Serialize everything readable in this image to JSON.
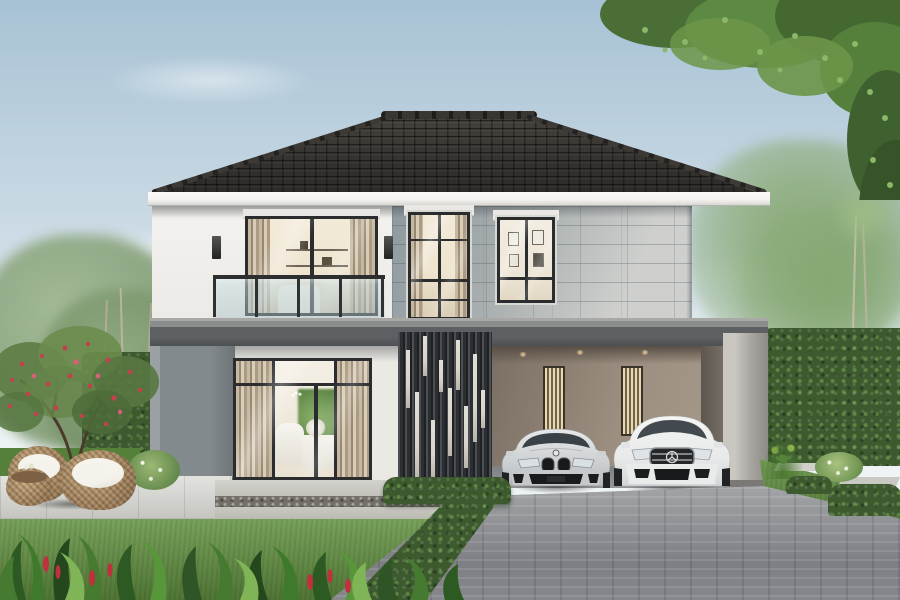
{
  "scene": {
    "type": "photorealistic architectural rendering",
    "setting": "two-story modern detached house, front elevation, daytime, landscaped garden",
    "objects": [
      "dark tiled hip roof with ridge caps",
      "white stucco second-floor wall",
      "gray stone tile cladding",
      "balcony with glass railing and sliding door",
      "sheer curtains behind glass",
      "tall gridded window",
      "square picture window showing framed art",
      "dark vertical slat privacy screen with light accent battens",
      "double carport with downlights and slit lamps",
      "silver BMW coupe parked",
      "white Mercedes sedan parked",
      "gray brick paver driveway",
      "manicured lawns",
      "trimmed box hedges",
      "two rattan egg chairs with white cushions",
      "rattan side table",
      "flowering tree with red blossoms",
      "slender palm trees",
      "overhanging tree canopy top right",
      "stepping-stone paths",
      "tropical foreground plants with red flower spikes",
      "soft blue sky with wispy clouds"
    ]
  },
  "palette": {
    "sky_top": "#a7c2d5",
    "sky_mid": "#cfdde6",
    "sky_bottom": "#ecf2f4",
    "roof_dark": "#38362f",
    "fascia_white": "#f6f5f2",
    "wall_white": "#f2f1ed",
    "stone_light": "#bcbebb",
    "slab_gray": "#5c6062",
    "panel_gray": "#838a8e",
    "frame_dark": "#2a2c2e",
    "interior_warm": "#eee4cf",
    "glass_tint": "#bcd3d8",
    "slat_dark": "#2c2f32",
    "slat_light": "#d8d4cb",
    "carport_wall": "#93857a",
    "light_warm": "#f0cf9a",
    "car_silver": "#d6d8d9",
    "car_white": "#f0f1f1",
    "lawn_light": "#669544",
    "lawn_dark": "#41702b",
    "hedge_green": "#3c5a2e",
    "foliage_light": "#7fae5a",
    "leaf_dark": "#24471d",
    "driveway_gray": "#94969a",
    "terrace_stone": "#d3d3ce",
    "pebble_dark": "#73706a",
    "wicker_tan": "#ad8c63",
    "cushion_white": "#f3f1ea",
    "flower_red": "#c2414e"
  }
}
